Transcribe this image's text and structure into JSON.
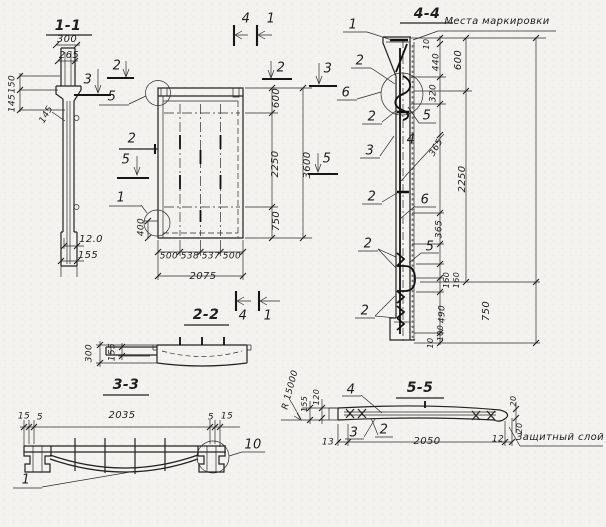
{
  "sheet": {
    "paper_color": "#f3f2ee",
    "ink_color": "#1f1f1f"
  },
  "sections": {
    "s11": {
      "title": "1-1",
      "dim_width_top": "300",
      "dim_width_inner": "265",
      "dim_left_150": "150",
      "dim_left_145a": "145",
      "dim_left_145b": "145",
      "dim_bottom_120": "12.0",
      "dim_bottom_155": "155"
    },
    "plan": {
      "cut_marks": {
        "top_4": "4",
        "top_1": "1",
        "bottom_4": "4",
        "bottom_1": "1",
        "left_2": "2",
        "left_3": "3",
        "mid_left_2": "2",
        "mid_left_5": "5",
        "right_2": "2",
        "right_3": "3",
        "mid_right_5": "5"
      },
      "detail_refs": {
        "top_5": "5",
        "bottom_1": "1"
      },
      "dims": {
        "right_600": "600",
        "right_2250": "2250",
        "right_750": "750",
        "right_total_3600": "3600",
        "left_400": "400",
        "bottom_500a": "500",
        "bottom_538": "538",
        "bottom_537": "537",
        "bottom_500b": "500",
        "bottom_total_2075": "2075"
      }
    },
    "s44": {
      "title": "4-4",
      "note_marking": "Места маркировки",
      "callouts_left": [
        "1",
        "2",
        "6",
        "2",
        "3",
        "2",
        "2",
        "2"
      ],
      "callouts_right": {
        "c5_upper": "5",
        "c4": "4",
        "c6": "6",
        "c5_lower": "5"
      },
      "dims": {
        "d10_top": "10",
        "d440": "440",
        "d600": "600",
        "d320": "320",
        "d365_upper": "365",
        "d2250": "2250",
        "d365_lower": "365",
        "d160a": "160",
        "d160b": "160",
        "d490": "490",
        "d750": "750",
        "d100": "100",
        "d10_bottom": "10"
      }
    },
    "s22": {
      "title": "2-2",
      "dim_300": "300",
      "dim_155": "155"
    },
    "s33": {
      "title": "3-3",
      "dims": {
        "d15_left": "15",
        "d5_left": "5",
        "d2035": "2035",
        "d5_right": "5",
        "d15_right": "15"
      },
      "detail_ref_10": "10",
      "callout_1": "1"
    },
    "s55": {
      "title": "5-5",
      "note_protective": "Защитный слой",
      "radius": "R 15000",
      "callouts": {
        "c4": "4",
        "c3": "3",
        "c2": "2"
      },
      "dims": {
        "d120": "120",
        "d155": "155",
        "d13": "13",
        "d2050": "2050",
        "d12": "12",
        "d20_top": "20",
        "d20_bottom": "20"
      }
    }
  }
}
